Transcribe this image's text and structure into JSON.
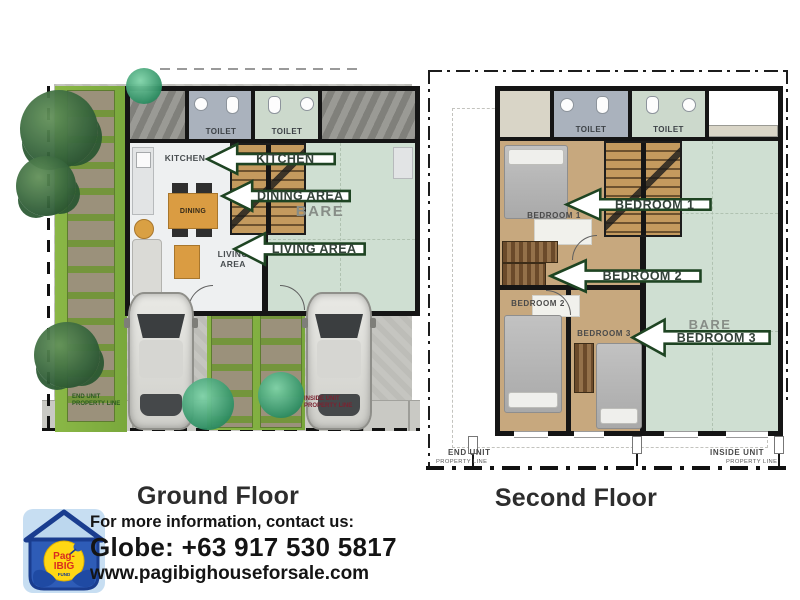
{
  "ground_floor": {
    "caption": "Ground Floor",
    "labels": {
      "toilet_left": "TOILET",
      "toilet_right": "TOILET",
      "kitchen_room": "KITCHEN",
      "dining_table": "DINING",
      "living_room": "LIVING\nAREA",
      "bare_room": "BARE",
      "end_unit": "END UNIT",
      "property_line_left": "PROPERTY LINE",
      "inside_unit": "INSIDE UNIT",
      "property_line_right": "PROPERTY LINE"
    },
    "arrows": [
      {
        "label": "KITCHEN"
      },
      {
        "label": "DINING AREA"
      },
      {
        "label": "LIVING AREA"
      }
    ]
  },
  "second_floor": {
    "caption": "Second Floor",
    "labels": {
      "toilet_left": "TOILET",
      "toilet_right": "TOILET",
      "bedroom1": "BEDROOM 1",
      "bedroom2": "BEDROOM 2",
      "bedroom3": "BEDROOM 3",
      "bare_room": "BARE",
      "end_unit": "END UNIT",
      "property_line_left": "PROPERTY LINE",
      "inside_unit": "INSIDE UNIT",
      "property_line_right": "PROPERTY LINE"
    },
    "arrows": [
      {
        "label": "BEDROOM 1"
      },
      {
        "label": "BEDROOM 2"
      },
      {
        "label": "BEDROOM 3"
      }
    ]
  },
  "footer": {
    "contact_intro": "For more information, contact us:",
    "phone": "Globe: +63 917 530 5817",
    "website": "www.pagibighouseforsale.com",
    "logo": {
      "line1": "Pag-",
      "line2": "IBIG",
      "line3": "FUND"
    }
  },
  "colors": {
    "arrow_border": "#1e4422",
    "arrow_text": "#34433a",
    "bare_green": "#cfdfd2",
    "lawn_green": "#8ab746",
    "wood_floor": "#c7a87e",
    "wall_black": "#151515",
    "logo_blue": "#1b3e91",
    "logo_yellow": "#ffd714",
    "logo_red": "#d92b1f"
  }
}
